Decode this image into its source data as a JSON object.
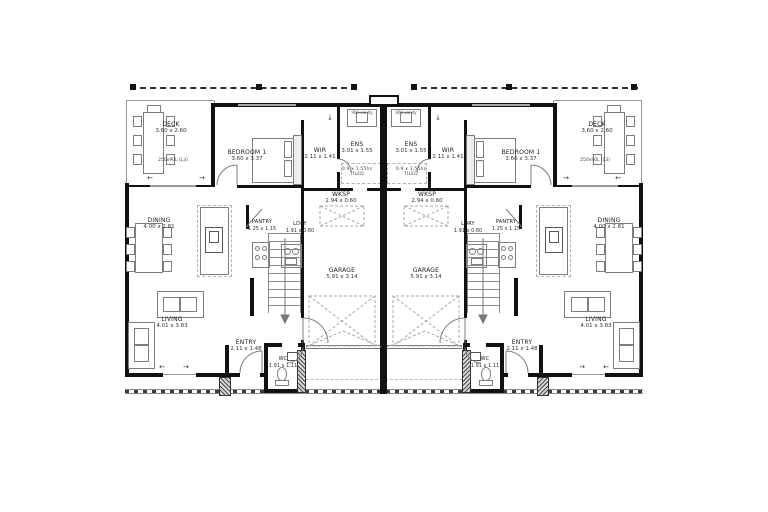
{
  "drawing": {
    "type": "floor-plan",
    "units": "metres",
    "mirrored_duplex": true
  },
  "rooms": {
    "deck": {
      "name": "DECK",
      "dims": "3.60 x 2.60",
      "note": "250x90L (L3)"
    },
    "bedroom1": {
      "name": "BEDROOM 1",
      "dims": "3.60 x 3.37"
    },
    "wir": {
      "name": "WIR",
      "dims": "2.11 x 1.41"
    },
    "ens": {
      "name": "ENS",
      "dims": "3.01 x 1.55",
      "shower_dims": "0.9 x 1.55hs",
      "shower_note": "TILED",
      "vanity_note": "900 vanity"
    },
    "wksp": {
      "name": "WKSP",
      "dims": "2.94 x 0.60"
    },
    "dining": {
      "name": "DINING",
      "dims": "4.00 x 2.81"
    },
    "pantry": {
      "name": "PANTRY",
      "dims": "1.25 x 1.15"
    },
    "ldry": {
      "name": "LDRY",
      "dims": "1.91 x 0.60"
    },
    "garage": {
      "name": "GARAGE",
      "dims": "5.91 x 3.14"
    },
    "living": {
      "name": "LIVING",
      "dims": "4.01 x 3.83"
    },
    "entry": {
      "name": "ENTRY",
      "dims": "2.11 x 1.48"
    },
    "wc": {
      "name": "WC",
      "dims": "1.91 x 1.11"
    }
  },
  "icons": {
    "down_arrow": "↓",
    "left_arrow": "←",
    "right_arrow": "→"
  },
  "colors": {
    "wall": "#111111",
    "furniture_line": "#7d7d7d",
    "background": "#ffffff"
  }
}
